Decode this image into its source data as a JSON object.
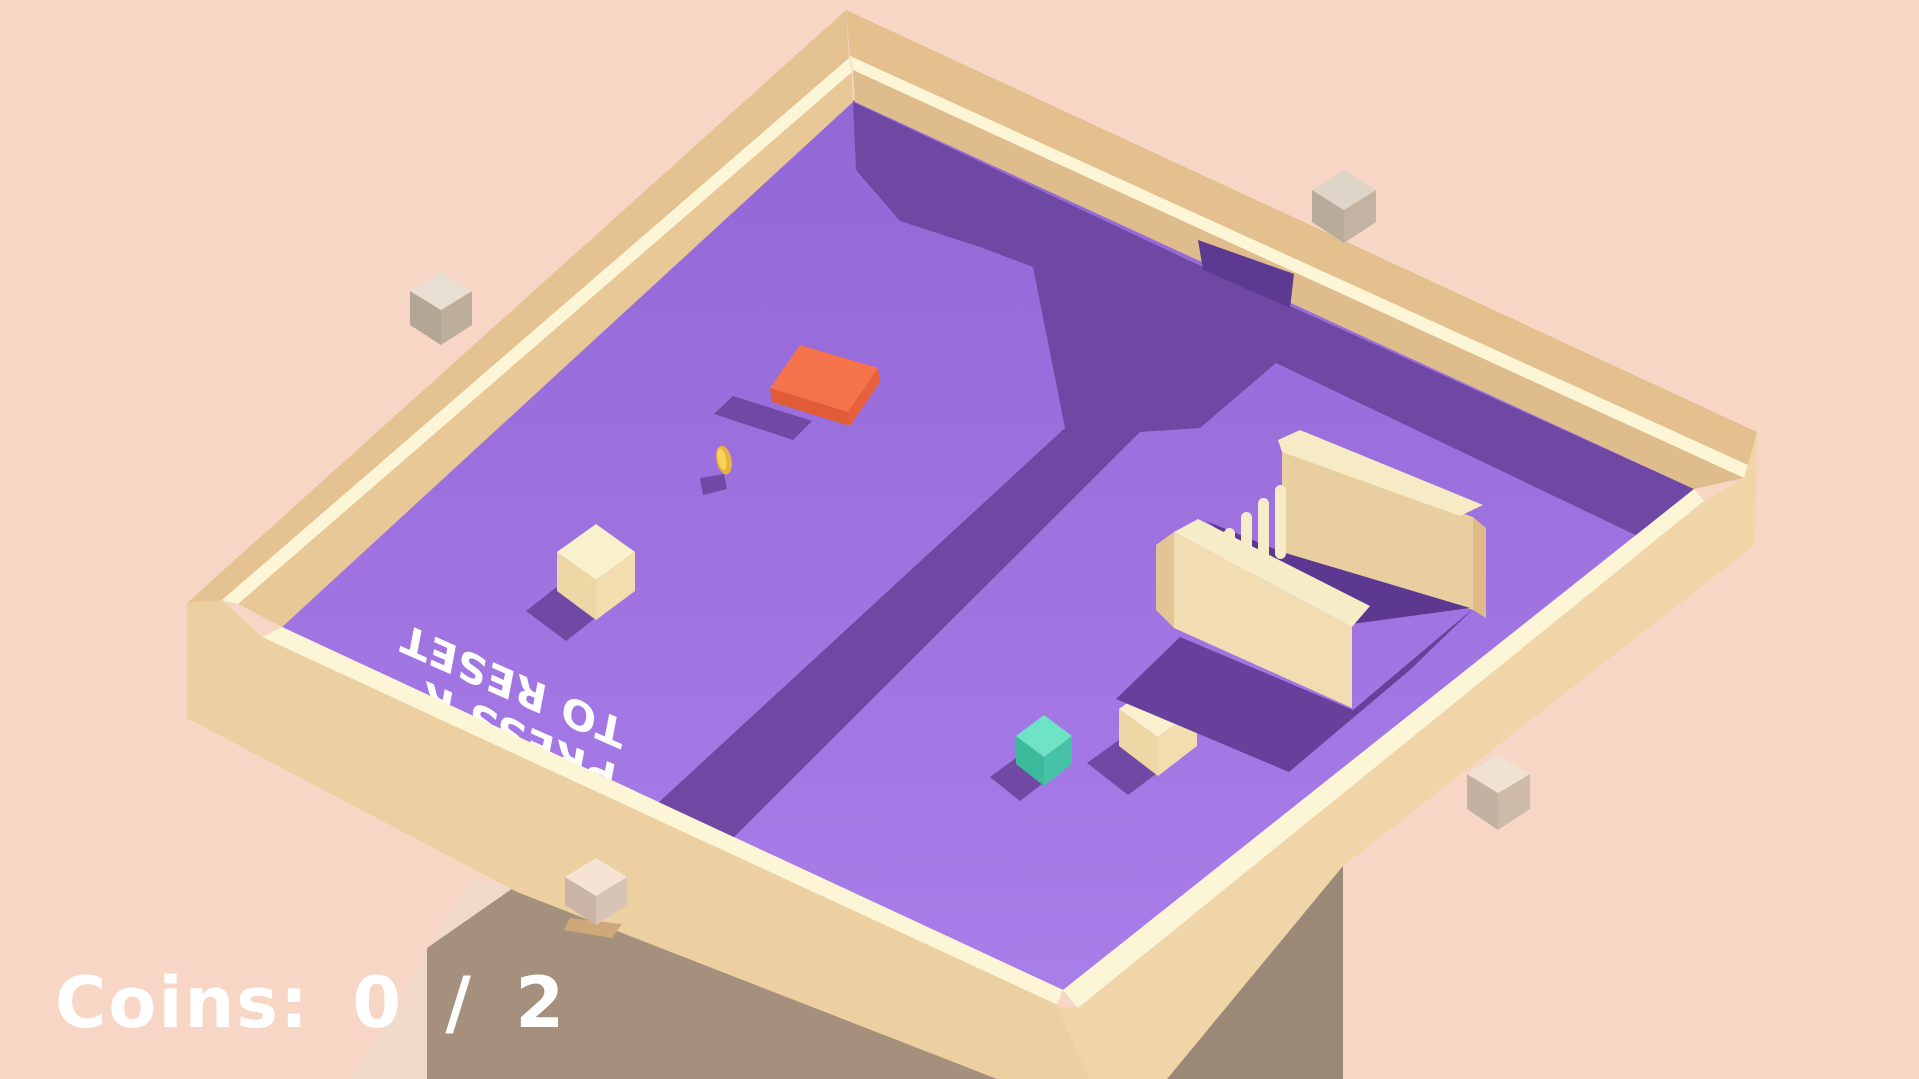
{
  "meta": {
    "title": "voxel puzzle game screenshot",
    "width": 1919,
    "height": 1079
  },
  "hud": {
    "coins_label": "Coins: 0 / 2"
  },
  "floor_text": {
    "line1": "PRESS R",
    "line2": "TO RESET"
  },
  "colors": {
    "background": "#f8d6c5",
    "floor_top": "#9267d6",
    "floor_bottom": "#a97ee9",
    "shadow_purple": "#6f48a3",
    "wall_tan": "#e5c291",
    "rim_cream": "#fdf6d6",
    "pedestal": "#a5907e",
    "accent_orange": "#f5734a",
    "coin_gold": "#e7b33c",
    "player_cream": "#f9f0cc",
    "teal": "#6fe3c5"
  },
  "scene": {
    "layers": [
      {
        "type": "poly",
        "name": "pedestal-left-face",
        "fill": "#f2dacb",
        "points": "470,878 516,886 427,950 427,1079 352,1079"
      },
      {
        "type": "poly",
        "name": "pedestal-front-face",
        "fill": "#a5907e",
        "points": "516,886 1000,1079 427,1079 427,948"
      },
      {
        "type": "poly",
        "name": "pedestal-right-face",
        "fill": "#9c8877",
        "points": "1343,864 1343,1079 1167,1079"
      },
      {
        "type": "poly",
        "name": "board-floor",
        "fill": "url(#floorGrad)",
        "points": "853,100 1694,489 1063,990 282,627"
      },
      {
        "type": "poly",
        "name": "wall-shadow-and-trench",
        "fill": "#6f48a3",
        "points": "853,102 1205,268 1290,306 1283,357 1200,428 1140,432 733,838 658,803 1065,428 1033,267 980,247 900,221 856,170"
      },
      {
        "type": "poly",
        "name": "wall-shadow-east",
        "fill": "#6f48a3",
        "points": "1290,306 1694,489 1650,542 1253,352"
      },
      {
        "type": "poly",
        "name": "orange-pad-shadow",
        "fill": "#7049a4",
        "points": "733,396 812,421 793,440 714,414"
      },
      {
        "type": "poly",
        "name": "coin-shadow",
        "fill": "#7049a4",
        "points": "700,478 724,474 727,489 703,495"
      },
      {
        "type": "poly",
        "name": "player-cube-shadow",
        "fill": "#7049a4",
        "points": "558,586 598,616 566,641 526,611"
      },
      {
        "type": "poly",
        "name": "teal-cube-shadow",
        "fill": "#7049a4",
        "points": "1016,758 1046,781 1020,801 990,777"
      },
      {
        "type": "poly",
        "name": "cream-cube-shadow",
        "fill": "#7049a4",
        "points": "1119,740 1160,771 1128,795 1087,763"
      },
      {
        "type": "floortext",
        "name": "floor-hint-text",
        "size": 41,
        "matrix": [
          -0.97,
          -0.43,
          0.18,
          -0.95,
          618,
          766
        ],
        "lines": [
          {
            "key": "line1",
            "x": 0,
            "y": 0
          },
          {
            "key": "line2",
            "x": 0,
            "y": 47
          }
        ]
      },
      {
        "type": "poly",
        "name": "orange-pad-side",
        "fill": "#e25b37",
        "points": "770,388 848,412 850,426 772,402"
      },
      {
        "type": "poly",
        "name": "orange-pad-side-right",
        "fill": "#e8603a",
        "points": "848,412 878,368 880,382 850,426"
      },
      {
        "type": "poly",
        "name": "orange-pad-top",
        "fill": "#f5734a",
        "points": "800,345 878,368 848,412 770,388"
      },
      {
        "type": "ellipse",
        "name": "coin",
        "fill": "#e7b33c",
        "cx": 724,
        "cy": 460,
        "rx": 7.5,
        "ry": 14.5,
        "rot": -12
      },
      {
        "type": "ellipse",
        "name": "coin-highlight",
        "fill": "#f6d35c",
        "cx": 722,
        "cy": 459,
        "rx": 4,
        "ry": 11,
        "rot": -12
      },
      {
        "type": "poly",
        "name": "player-cube-left-face",
        "fill": "#eed7a4",
        "points": "557,552 596,580 596,620 557,591"
      },
      {
        "type": "poly",
        "name": "player-cube-right-face",
        "fill": "#f3dcae",
        "points": "596,580 635,552 635,591 596,620"
      },
      {
        "type": "poly",
        "name": "player-cube-top-face",
        "fill": "#f9f0cc",
        "points": "596,524 635,552 596,580 557,552"
      },
      {
        "type": "poly",
        "name": "teal-cube-left-face",
        "fill": "#3bb99b",
        "points": "1016,736 1044,757 1044,786 1016,764"
      },
      {
        "type": "poly",
        "name": "teal-cube-right-face",
        "fill": "#46c3a6",
        "points": "1044,757 1072,736 1072,764 1044,786"
      },
      {
        "type": "poly",
        "name": "teal-cube-top-face",
        "fill": "#6fe3c5",
        "points": "1044,715 1072,736 1044,757 1016,736"
      },
      {
        "type": "poly",
        "name": "cream-cube-left-face",
        "fill": "#eed7a4",
        "points": "1119,709 1158,737 1158,776 1119,746"
      },
      {
        "type": "poly",
        "name": "cream-cube-right-face",
        "fill": "#f3dcae",
        "points": "1158,737 1197,709 1197,746 1158,776"
      },
      {
        "type": "poly",
        "name": "cream-cube-top-face",
        "fill": "#faf0cf",
        "points": "1158,681 1197,709 1158,737 1119,709"
      },
      {
        "type": "poly",
        "name": "enclosure-shadow",
        "fill": "#66409b",
        "points": "1180,637 1353,710 1475,607 1411,669 1289,772 1116,699"
      },
      {
        "type": "poly",
        "name": "enclosure-back-wall-face",
        "fill": "#e9cf9f",
        "points": "1282,452 1473,517 1473,610 1282,552"
      },
      {
        "type": "poly",
        "name": "enclosure-back-wall-top",
        "fill": "#f6ebc4",
        "points": "1278,440 1300,430 1483,505 1460,516 1282,452"
      },
      {
        "type": "poly",
        "name": "enclosure-back-wall-cap",
        "fill": "#dfba88",
        "points": "1473,517 1486,528 1486,618 1473,610"
      },
      {
        "type": "poly",
        "name": "enclosure-interior-shadow",
        "fill": "#5c3890",
        "points": "1282,552 1470,608 1352,624 1206,521"
      },
      {
        "type": "rect",
        "name": "pillar-1",
        "fill": "#f6ecca",
        "x": 1224,
        "y": 528,
        "w": 11,
        "h": 44,
        "rx": 5.5
      },
      {
        "type": "rect",
        "name": "pillar-2",
        "fill": "#f6ecca",
        "x": 1241,
        "y": 512,
        "w": 11,
        "h": 62,
        "rx": 5.5
      },
      {
        "type": "rect",
        "name": "pillar-3",
        "fill": "#f6ecca",
        "x": 1258,
        "y": 498,
        "w": 11,
        "h": 78,
        "rx": 5.5
      },
      {
        "type": "rect",
        "name": "pillar-4",
        "fill": "#f6ecca",
        "x": 1275,
        "y": 485,
        "w": 11,
        "h": 74,
        "rx": 5.5
      },
      {
        "type": "poly",
        "name": "enclosure-front-wall-cap",
        "fill": "#e3c494",
        "points": "1156,545 1174,532 1174,628 1156,610"
      },
      {
        "type": "poly",
        "name": "enclosure-front-wall-face",
        "fill": "#f2dcb1",
        "points": "1174,532 1352,627 1352,708 1174,628"
      },
      {
        "type": "poly",
        "name": "enclosure-front-wall-top",
        "fill": "#f7ecc8",
        "points": "1174,532 1198,519 1370,606 1352,627"
      },
      {
        "type": "poly",
        "name": "board-wall-topleft-topface",
        "fill": "#e5c291",
        "points": "846,10 849,58 222,600 187,603"
      },
      {
        "type": "poly",
        "name": "board-wall-topleft-rim",
        "fill": "#fdf6d6",
        "points": "849,58 852,72 238,604 222,600"
      },
      {
        "type": "poly",
        "name": "board-wall-topleft-inner",
        "fill": "#e9c897",
        "points": "852,72 853,102 282,627 238,604"
      },
      {
        "type": "poly",
        "name": "board-wall-topright-topface",
        "fill": "#e3c08e",
        "points": "846,10 1757,432 1750,466 850,56"
      },
      {
        "type": "poly",
        "name": "board-wall-topright-rim",
        "fill": "#fdf6d6",
        "points": "850,56 1750,466 1744,478 853,70"
      },
      {
        "type": "poly",
        "name": "board-wall-topright-inner",
        "fill": "#dfbc8b",
        "points": "853,70 1744,478 1694,489 855,102"
      },
      {
        "type": "poly",
        "name": "board-wall-bottomleft-rim",
        "fill": "#fdf6d6",
        "points": "282,627 1063,990 1056,1006 262,637"
      },
      {
        "type": "poly",
        "name": "board-wall-bottomleft-face",
        "fill": "#ecd0a1",
        "points": "262,637 1058,1005 1090,1079 997,1079 517,892 187,718 187,603 222,600"
      },
      {
        "type": "poly",
        "name": "board-wall-bottomright-rim",
        "fill": "#fdf6d6",
        "points": "1063,990 1694,489 1704,501 1078,1008"
      },
      {
        "type": "poly",
        "name": "board-wall-bottomright-face",
        "fill": "#f0d5a8",
        "points": "1056,1006 1078,1008 1704,501 1744,478 1757,432 1755,545 1343,866 1167,1079 1090,1079"
      },
      {
        "type": "poly",
        "name": "wall-gap-opening",
        "fill": "#5d3a92",
        "points": "1198,240 1294,274 1290,308 1203,270"
      },
      {
        "type": "poly",
        "name": "floating-cube-1-left",
        "fill": "#b3a695",
        "points": "410,291 441,310 441,345 410,325"
      },
      {
        "type": "poly",
        "name": "floating-cube-1-right",
        "fill": "#bdae9c",
        "points": "441,310 472,291 472,325 441,345"
      },
      {
        "type": "poly",
        "name": "floating-cube-1-top",
        "fill": "#e8dfd2",
        "points": "441,272 472,291 441,310 410,291"
      },
      {
        "type": "poly",
        "name": "floating-cube-2-left",
        "fill": "#b9ab9b",
        "points": "1312,190 1344,210 1344,243 1312,222"
      },
      {
        "type": "poly",
        "name": "floating-cube-2-right",
        "fill": "#c2b3a2",
        "points": "1344,210 1376,190 1376,222 1344,243"
      },
      {
        "type": "poly",
        "name": "floating-cube-2-top",
        "fill": "#ded5c8",
        "points": "1344,170 1376,190 1344,210 1312,190"
      },
      {
        "type": "poly",
        "name": "floating-cube-3-left",
        "fill": "#c4b1a1",
        "points": "1467,774 1498,793 1498,830 1467,809"
      },
      {
        "type": "poly",
        "name": "floating-cube-3-right",
        "fill": "#cdbaa9",
        "points": "1498,793 1530,774 1530,809 1498,830"
      },
      {
        "type": "poly",
        "name": "floating-cube-3-top",
        "fill": "#f0e2d3",
        "points": "1498,755 1530,774 1498,793 1467,774"
      },
      {
        "type": "poly",
        "name": "floating-cube-4-shadow",
        "fill": "#cfa87a",
        "points": "570,918 622,924 612,938 564,930"
      },
      {
        "type": "poly",
        "name": "floating-cube-4-left",
        "fill": "#c9b4a5",
        "points": "565,877 596,896 596,925 565,905"
      },
      {
        "type": "poly",
        "name": "floating-cube-4-right",
        "fill": "#d8c4b4",
        "points": "596,896 627,877 627,905 596,925"
      },
      {
        "type": "poly",
        "name": "floating-cube-4-top",
        "fill": "#f6e3d4",
        "points": "596,858 627,877 596,896 565,877"
      }
    ]
  }
}
